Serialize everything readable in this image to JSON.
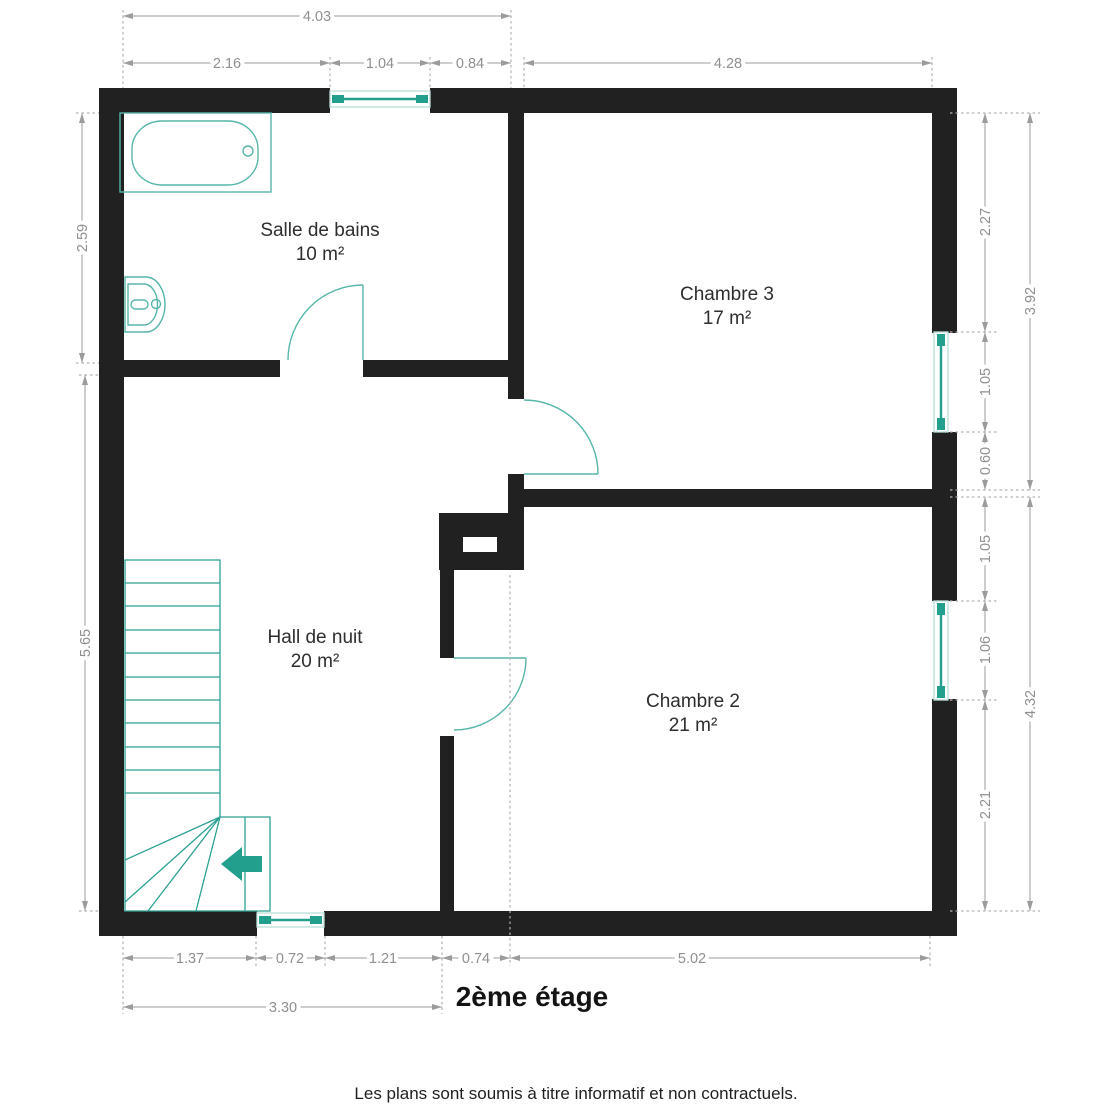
{
  "title": "2ème étage",
  "disclaimer": "Les plans sont soumis à titre informatif et non contractuels.",
  "rooms": [
    {
      "name": "Salle de bains",
      "area": "10 m²"
    },
    {
      "name": "Chambre 3",
      "area": "17 m²"
    },
    {
      "name": "Hall de nuit",
      "area": "20 m²"
    },
    {
      "name": "Chambre 2",
      "area": "21 m²"
    }
  ],
  "dims": {
    "top": {
      "total": "4.03",
      "segs": [
        "2.16",
        "1.04",
        "0.84",
        "4.28"
      ]
    },
    "left": {
      "segs": [
        "2.59",
        "5.65"
      ]
    },
    "right_inner": {
      "segs": [
        "2.27",
        "1.05",
        "0.60",
        "1.05",
        "1.06",
        "2.21"
      ]
    },
    "right_outer": {
      "segs": [
        "3.92",
        "4.32"
      ]
    },
    "bottom": {
      "segs": [
        "1.37",
        "0.72",
        "1.21",
        "0.74",
        "5.02"
      ],
      "total": "3.30"
    }
  },
  "icons": {
    "stairs_direction": "left-arrow"
  },
  "colors": {
    "wall": "#212121",
    "teal": "#239f8e",
    "fixture": "#57b6aa",
    "stairs": "#2ba193",
    "win_pale": "#b9ded9",
    "dim_line": "#9b9b9b",
    "ext_line": "#b2b2b2",
    "dim_text": "#8f8f8f",
    "room_text": "#2e2e2e"
  }
}
